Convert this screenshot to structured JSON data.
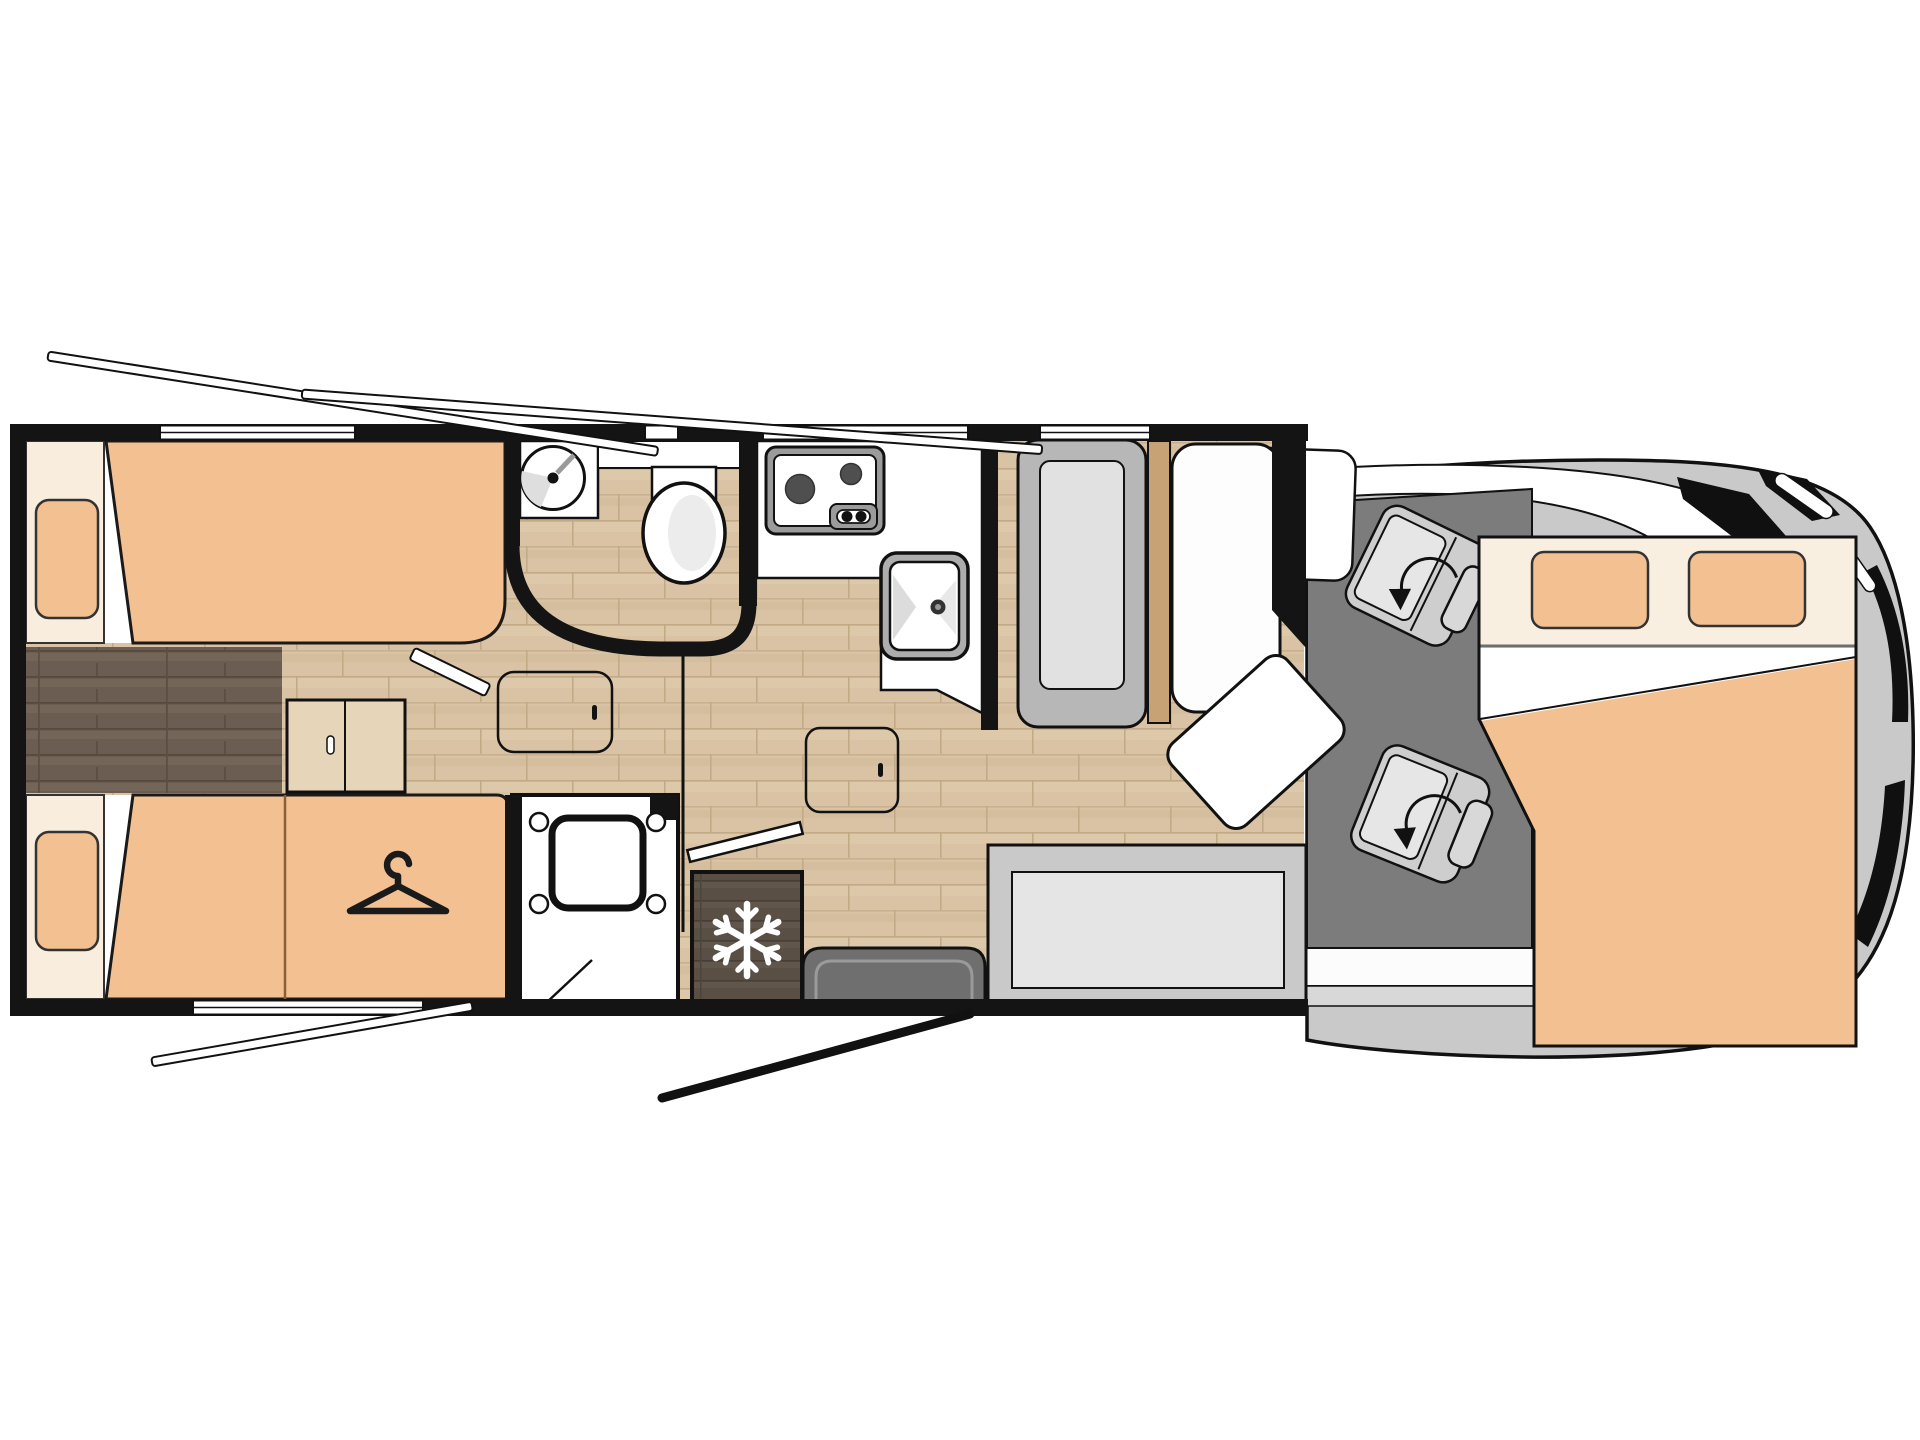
{
  "diagram": {
    "type": "motorhome-floor-plan",
    "view": "top-down",
    "rooms": [
      "rear-twin-bedroom",
      "bathroom",
      "wardrobe",
      "shower",
      "kitchen",
      "dinette",
      "cab",
      "overcab-bed"
    ],
    "furniture": [
      "twin-bed-top",
      "twin-bed-bottom",
      "center-steps",
      "wardrobe",
      "shower-tray",
      "fridge",
      "bathroom-sink",
      "toilet",
      "stove",
      "kitchen-sink",
      "dinette-bench-left",
      "dinette-bench-right",
      "dinette-table",
      "bottom-bench",
      "entry-door",
      "swivel-seat-front",
      "swivel-seat-rear",
      "drop-down-bed",
      "pillow-left",
      "pillow-right"
    ]
  },
  "icons": [
    "snowflake-icon",
    "hanger-icon",
    "rotation-arrow-icon"
  ],
  "colors": {
    "wall": "#141414",
    "mattress": "#f3c191",
    "bed_panel": "#f9eedd",
    "bed_header": "#f9efe1",
    "floor_light": "#d9c3a4",
    "floor_dark": "#6b5d51",
    "fridge_wood": "#5a4f45",
    "cab_floor": "#7c7c7c",
    "vehicle_body": "#c9c9c9",
    "seat_grey": "#cecece",
    "bench_grey": "#b7b7b7",
    "cushion_light": "#e1e1e1",
    "door_grey": "#6f6f6f",
    "wood_trim": "#c7a274",
    "steps_wood": "#e6d5b8",
    "appliance_grey": "#9b9b9b",
    "white": "#ffffff"
  }
}
